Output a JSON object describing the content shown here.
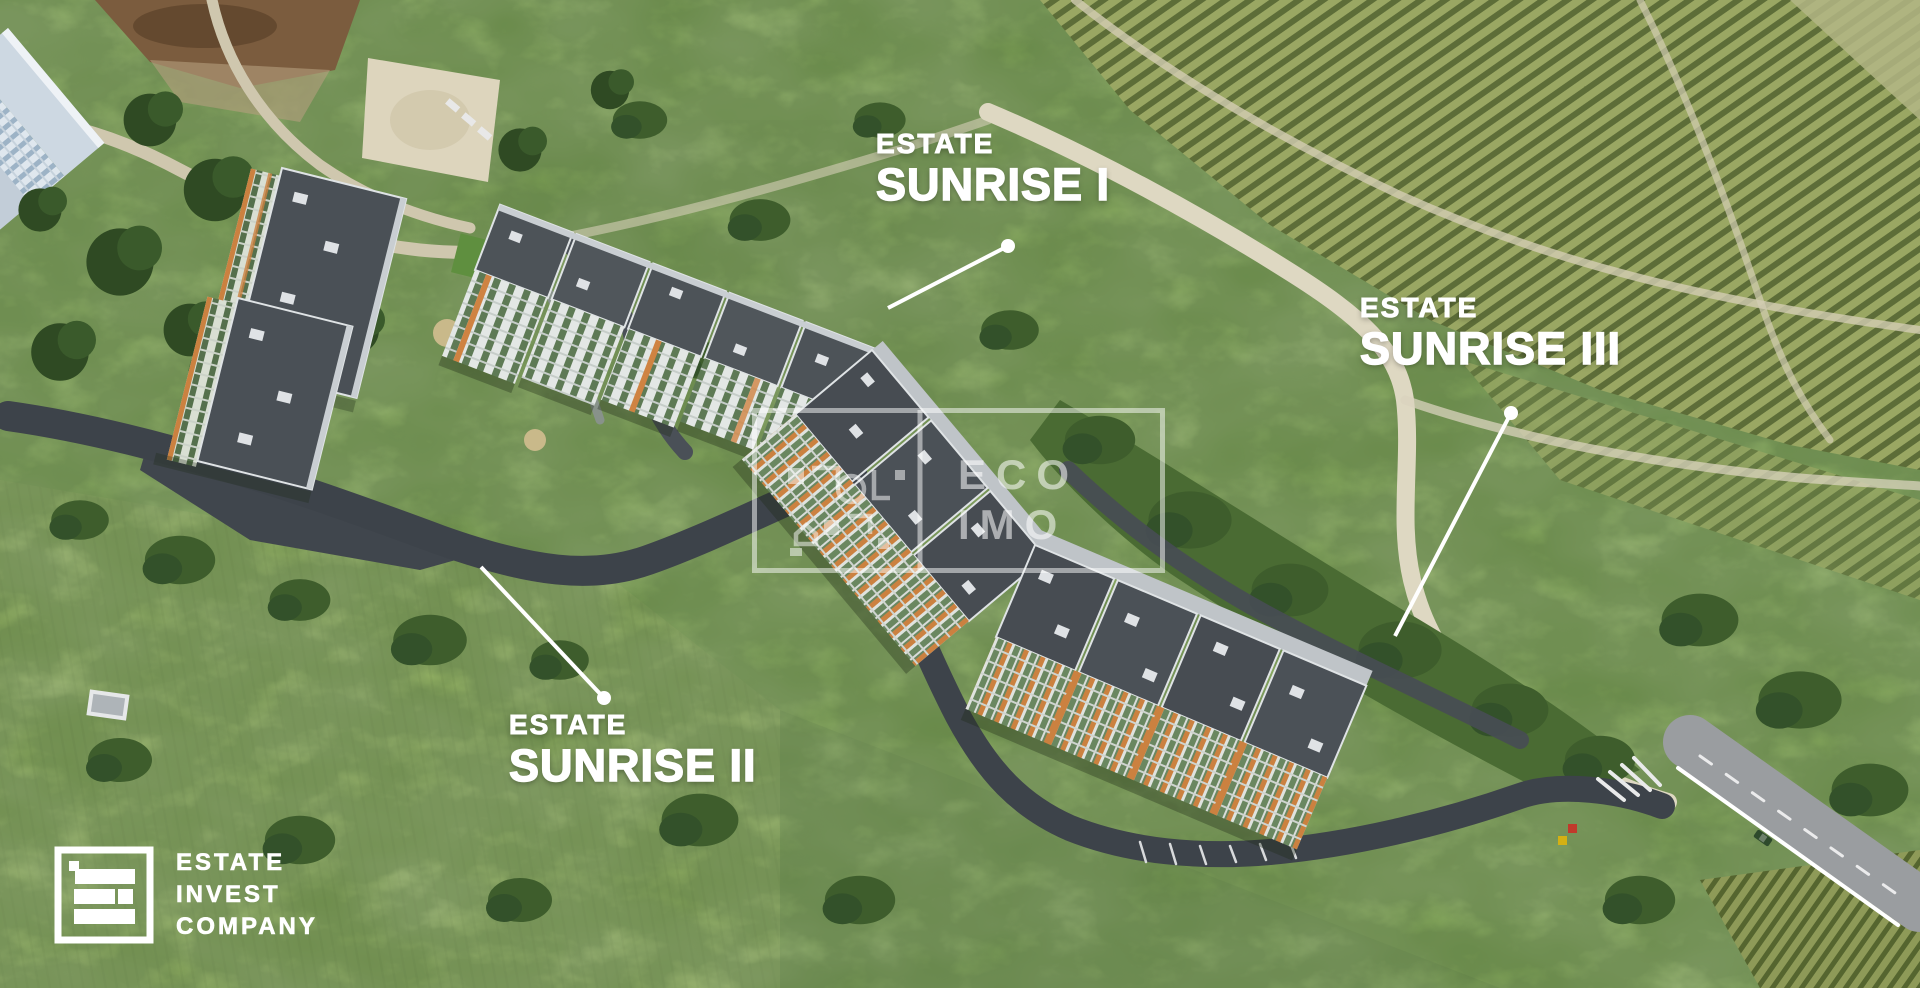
{
  "annotations": {
    "sunrise_i": {
      "eyebrow": "ESTATE",
      "title": "SUNRISE I"
    },
    "sunrise_ii": {
      "eyebrow": "ESTATE",
      "title": "SUNRISE II"
    },
    "sunrise_iii": {
      "eyebrow": "ESTATE",
      "title": "SUNRISE III"
    }
  },
  "watermark": {
    "line1": "ECO",
    "line2": "IMO"
  },
  "logo": {
    "line1": "ESTATE",
    "line2": "INVEST",
    "line3": "COMPANY"
  },
  "colors": {
    "label_text": "#ffffff",
    "watermark_white": "rgba(255,255,255,0.55)",
    "meadow_green": "#79a04c",
    "vineyard_row": "#5d6d38",
    "dirt_road": "#d9d3bd",
    "asphalt_road": "#3d434a",
    "roof_grey": "#4a5056",
    "facade_orange": "#cb8140",
    "glass_green": "#5e7a55",
    "car_blue": "#2b59c9",
    "car_yellow": "#e6c01f"
  }
}
